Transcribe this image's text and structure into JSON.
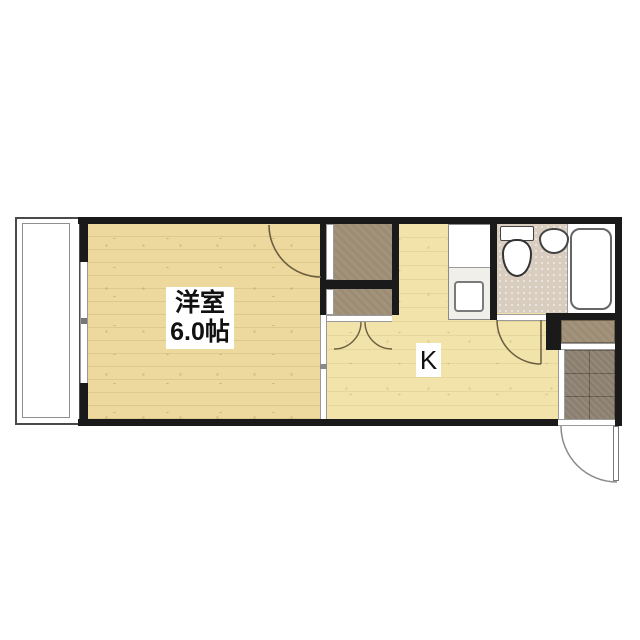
{
  "plan": {
    "type": "apartment-floor-plan",
    "layout_name": "1K"
  },
  "labels": {
    "room_name": "洋室",
    "room_size": "6.0帖",
    "kitchen": "K"
  },
  "rooms": [
    {
      "id": "western-room",
      "label": "洋室 6.0帖"
    },
    {
      "id": "kitchen",
      "label": "K"
    },
    {
      "id": "bathroom",
      "label": ""
    },
    {
      "id": "balcony",
      "label": ""
    },
    {
      "id": "entrance",
      "label": ""
    }
  ],
  "fixtures": [
    "balcony",
    "sliding-window",
    "closet-upper",
    "closet-lower",
    "kitchen-counter",
    "stove",
    "toilet",
    "washbasin",
    "bathtub",
    "shoe-cabinet",
    "entrance-tile",
    "entry-door",
    "room-door",
    "closet-double-doors",
    "bathroom-door",
    "room-kitchen-sliding-partition"
  ],
  "colors": {
    "background": "#ffffff",
    "wall": "#1a1a1a",
    "room_floor": "#edd99e",
    "kitchen_floor": "#f1e3aa",
    "closet_brown": "#9c8c74",
    "bathroom_floor": "#d9cdbf",
    "entrance_tile": "#8b7f70",
    "door_arc": "#6b5d40"
  }
}
